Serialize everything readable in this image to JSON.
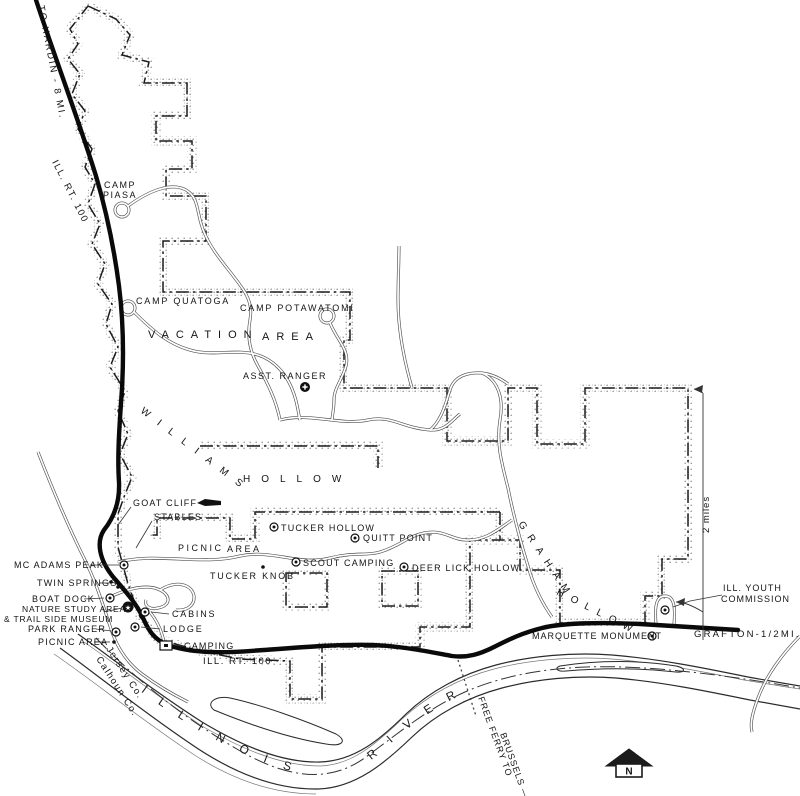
{
  "map": {
    "colors": {
      "ink": "#141414",
      "paper": "#ffffff",
      "stipple": "#8f8f8f",
      "highway": "#0a0a0a"
    }
  },
  "geometry": {
    "boundary": [
      "M88,6 L116,19 L130,35 L122,55 L149,62 L144,83 L187,83 L187,116 L156,116 L156,141 L192,141 L192,169 L166,169 L166,196 L206,196 L206,241 L163,241 L163,292 L350,292 L350,340 L344,340 L344,388 L447,388 L447,441 L508,441 L508,388 L537,388 L537,444 L585,444 L585,388 L688,388 L688,559 L662,559 L662,596 L645,596 L645,623 L560,623 L560,570 L520,570 L520,540 L470,540 L470,627 L420,627 L420,647 L322,647 L322,699 L290,699 L290,661 L240,659 L200,651 L158,639 L140,617 L128,584 L118,547 L118,514 L124,497 L132,477 L120,454 L128,434 L118,411 L125,391 L110,367 L118,347 L106,324 L112,304 L98,284 L105,264 L92,244 L100,224 L88,204 L95,184 L85,167 L92,149 L78,129 L85,111 L72,94 L80,74 L68,59 L78,44 L70,29 Z",
      "M500,512 L255,512 L255,539 L230,539 L230,518 L157,518 L157,535 L150,535",
      "M500,512 L500,540",
      "M200,446 L378,446 L378,468",
      "M286,573 h41 v34 h-41 Z",
      "M382,571 h36 v35 h-36 Z"
    ],
    "roads": [
      "M122,210 m-7,0 a7,7 0 1 0 14,0 a7,7 0 1 0 -14,0",
      "M128,206 C150,190 172,182 186,190 C200,198 196,214 204,232 C212,252 228,268 240,285 C250,298 252,308 250,320 C247,336 250,352 258,366 C268,384 276,400 280,420",
      "M128,308 m-7,0 a7,7 0 1 0 14,0 a7,7 0 1 0 -14,0",
      "M134,312 C152,330 168,344 190,350 C214,357 236,348 258,355 C276,361 288,376 294,394 C298,406 298,412 300,420",
      "M327,316 m-7,0 a7,7 0 1 0 14,0 a7,7 0 1 0 -14,0",
      "M330,323 C338,342 350,350 346,366 C342,380 334,388 334,400 C334,410 332,416 332,420",
      "M280,420 C310,412 340,426 368,420 C392,415 402,428 430,430 C446,431 452,420 460,414",
      "M430,430 C442,420 446,402 450,390 C454,376 468,372 482,373 C492,374 500,378 508,384",
      "M412,388 C404,360 398,330 398,300 C398,280 399,262 399,246",
      "M482,373 C498,380 504,398 500,420 C496,444 502,464 508,488 C512,508 520,540 528,566 C534,588 544,606 552,617",
      "M118,562 C160,552 200,566 240,556 C272,549 300,566 330,558 C352,552 368,556 380,552 C400,546 408,536 424,533 C444,529 452,540 466,540 C486,541 500,528 512,520",
      "M112,596 C130,588 148,584 160,590 C172,596 170,606 158,608 C150,610 144,606 146,600",
      "M160,590 C176,580 192,584 194,596 C195,606 186,611 176,610",
      "M150,612 C158,622 162,632 164,642",
      "M38,452 C52,488 68,526 84,558 C96,582 102,602 110,626 C116,646 126,662 142,674 C158,686 172,694 188,702",
      "M800,636 C782,654 766,676 758,698 C752,714 750,724 752,732",
      "M656,624 C654,602 658,596 665,596 C672,596 676,602 674,624"
    ],
    "highway": "M36,0 C55,58 78,118 96,176 C106,210 114,248 119,286 C123,318 124,352 122,388 C120,420 117,452 119,482 C120,504 112,520 104,530 C96,542 99,560 114,578 C128,594 138,606 144,620 C150,634 158,643 174,647 C204,655 236,652 264,650 C304,647 342,644 372,645 C402,646 430,652 452,656 C468,658 480,654 494,647 C510,639 522,633 542,628 C562,623 600,622 640,624 C674,626 704,628 738,630",
    "river_banks": [
      "M78,634 C112,658 152,690 202,722 C242,746 282,763 320,762 C354,761 380,740 406,714 C430,691 462,674 496,665 C530,656 572,652 612,655 C660,659 704,668 748,677 C770,681 788,684 800,686",
      "M60,648 C96,674 138,708 188,742 C228,770 272,790 318,789 C356,788 386,762 412,737 C436,714 468,697 502,688 C536,679 576,675 616,678 C662,682 706,691 750,700 C772,704 788,707 800,709"
    ],
    "river_banks_detail": [
      "M84,642 C116,664 154,694 202,726 C240,748 280,766 320,766 C352,765 376,744 402,719 C428,695 460,678 494,669 C528,660 572,656 612,659 C658,663 700,671 744,680 C768,684 786,687 800,689",
      "M54,654 C92,680 134,714 184,748 C224,776 268,794 316,794"
    ],
    "islands": [
      "M214,710 C248,724 288,738 326,744 C342,747 348,741 336,734 C304,720 262,705 230,698 C216,695 205,703 214,710 Z",
      "M560,666 C598,660 640,660 676,666 C686,668 686,673 676,672 C640,668 600,668 566,671 C557,672 554,668 560,666 Z"
    ],
    "county_line": "M96,638 C140,684 190,722 242,752 C292,780 332,782 366,757 C400,732 432,705 472,689 C512,673 562,665 622,667 C682,669 742,678 800,688",
    "ferry_line": "M458,660 L476,716",
    "measure_lines": [
      "M703,393 L703,640",
      "M703,393 L694,389",
      "M703,612 C690,604 682,602 676,602"
    ],
    "measure_arrows": [
      "694,389 703,385 702,393",
      "676,602 685,598 684,606"
    ],
    "river_text_path": "M128,682 C178,720 228,752 290,771 C332,783 358,774 388,746 C418,719 444,701 476,689"
  },
  "labels": [
    {
      "id": "to-hardin",
      "text": "TO HARDIN - 8 MI.",
      "x": 38,
      "y": 6,
      "rot": 79,
      "ls": 2,
      "size": 9.5
    },
    {
      "id": "ill-rt-100-top",
      "text": "ILL. RT. 100",
      "x": 52,
      "y": 162,
      "rot": 63,
      "ls": 1.5,
      "size": 9.5
    },
    {
      "id": "camp-piasa-1",
      "text": "CAMP",
      "x": 104,
      "y": 188,
      "ls": 1.5,
      "size": 9
    },
    {
      "id": "camp-piasa-2",
      "text": "PIASA",
      "x": 103,
      "y": 198,
      "ls": 1.5,
      "size": 9
    },
    {
      "id": "camp-quatoga",
      "text": "CAMP QUATOGA",
      "x": 136,
      "y": 304,
      "ls": 1.8,
      "size": 9
    },
    {
      "id": "camp-potawatomi",
      "text": "CAMP POTAWATOMI",
      "x": 240,
      "y": 311,
      "ls": 1.8,
      "size": 9
    },
    {
      "id": "vacation",
      "text": "VACATION",
      "x": 148,
      "y": 338,
      "ls": 7,
      "size": 11
    },
    {
      "id": "vacation-area",
      "text": "AREA",
      "x": 262,
      "y": 340,
      "ls": 7,
      "size": 11
    },
    {
      "id": "asst-ranger",
      "text": "ASST. RANGER",
      "x": 243,
      "y": 379,
      "ls": 1.5,
      "size": 9
    },
    {
      "id": "williams",
      "text": "WILLIAMS",
      "x": 140,
      "y": 412,
      "rot": 37,
      "ls": 11,
      "size": 10
    },
    {
      "id": "williams-hollow",
      "text": "HOLLOW",
      "x": 243,
      "y": 482,
      "ls": 11,
      "size": 10
    },
    {
      "id": "goat-cliff",
      "text": "GOAT CLIFF",
      "x": 133,
      "y": 506,
      "ls": 1.2,
      "size": 9
    },
    {
      "id": "stables",
      "text": "STABLES",
      "x": 154,
      "y": 520,
      "ls": 1.2,
      "size": 9
    },
    {
      "id": "picnic-center",
      "text": "PICNIC",
      "x": 178,
      "y": 551,
      "ls": 2.5,
      "size": 9
    },
    {
      "id": "picnic-center-area",
      "text": "AREA",
      "x": 227,
      "y": 552,
      "ls": 2.5,
      "size": 9
    },
    {
      "id": "tucker-hollow",
      "text": "TUCKER HOLLOW",
      "x": 281,
      "y": 531,
      "ls": 1.2,
      "size": 9
    },
    {
      "id": "quitt-point",
      "text": "QUITT POINT",
      "x": 363,
      "y": 541,
      "ls": 1.2,
      "size": 9
    },
    {
      "id": "scout-camping",
      "text": "SCOUT CAMPING",
      "x": 303,
      "y": 566,
      "ls": 1.2,
      "size": 9
    },
    {
      "id": "tucker-knob",
      "text": "TUCKER KNOB",
      "x": 210,
      "y": 579,
      "ls": 1.8,
      "size": 9
    },
    {
      "id": "deer-lick-hollow",
      "text": "DEER LICK HOLLOW",
      "x": 412,
      "y": 571,
      "ls": 1.2,
      "size": 9
    },
    {
      "id": "graham",
      "text": "GRAHAM",
      "x": 518,
      "y": 524,
      "rot": 56,
      "ls": 8,
      "size": 10
    },
    {
      "id": "graham-hollow",
      "text": "HOLLOW",
      "x": 556,
      "y": 594,
      "rot": 27,
      "ls": 8,
      "size": 10
    },
    {
      "id": "mc-adams-peak",
      "text": "MC ADAMS PEAK",
      "x": 14,
      "y": 568,
      "ls": 1.2,
      "size": 9
    },
    {
      "id": "twin-springs",
      "text": "TWIN SPRINGS",
      "x": 37,
      "y": 586,
      "ls": 1.2,
      "size": 9
    },
    {
      "id": "boat-dock",
      "text": "BOAT DOCK",
      "x": 32,
      "y": 602,
      "ls": 1.2,
      "size": 9
    },
    {
      "id": "nature-study-area",
      "text": "NATURE STUDY AREA",
      "x": 22,
      "y": 612,
      "ls": 0.8,
      "size": 8.5
    },
    {
      "id": "trail-side-museum",
      "text": "& TRAIL SIDE MUSEUM",
      "x": 4,
      "y": 622,
      "ls": 0.8,
      "size": 8.5
    },
    {
      "id": "park-ranger",
      "text": "PARK RANGER",
      "x": 28,
      "y": 632,
      "ls": 1.2,
      "size": 9
    },
    {
      "id": "picnic-west",
      "text": "PICNIC AREA",
      "x": 38,
      "y": 645,
      "ls": 1.2,
      "size": 9
    },
    {
      "id": "cabins",
      "text": "CABINS",
      "x": 172,
      "y": 617,
      "ls": 1.8,
      "size": 9
    },
    {
      "id": "lodge",
      "text": "LODGE",
      "x": 163,
      "y": 632,
      "ls": 1.8,
      "size": 9
    },
    {
      "id": "camping",
      "text": "CAMPING",
      "x": 184,
      "y": 649,
      "ls": 1.2,
      "size": 9
    },
    {
      "id": "ill-rt-100-bottom",
      "text": "ILL. RT. 100",
      "x": 203,
      "y": 664,
      "ls": 1.5,
      "size": 9.5
    },
    {
      "id": "marquette-monument",
      "text": "MARQUETTE MONUMENT",
      "x": 532,
      "y": 639,
      "ls": 1,
      "size": 9
    },
    {
      "id": "grafton",
      "text": "GRAFTON-1/2MI.",
      "x": 694,
      "y": 637,
      "ls": 2.2,
      "size": 9.5
    },
    {
      "id": "ill-youth",
      "text": "ILL. YOUTH",
      "x": 723,
      "y": 591,
      "ls": 1,
      "size": 9
    },
    {
      "id": "commission",
      "text": "COMMISSION",
      "x": 721,
      "y": 602,
      "ls": 1,
      "size": 9
    },
    {
      "id": "two-miles",
      "text": "2 miles",
      "x": 709,
      "y": 533,
      "rot": -90,
      "ls": 1,
      "size": 9.5
    },
    {
      "id": "jersey-co",
      "text": "Jersey Co.",
      "x": 106,
      "y": 649,
      "rot": 57,
      "ls": 1.5,
      "size": 9.5
    },
    {
      "id": "calhoun-co",
      "text": "Calhoun Co.",
      "x": 96,
      "y": 659,
      "rot": 57,
      "ls": 1.5,
      "size": 9.5
    },
    {
      "id": "free-ferry-to",
      "text": "FREE FERRY TO",
      "x": 478,
      "y": 698,
      "rot": 70,
      "ls": 1,
      "size": 9
    },
    {
      "id": "brussels",
      "text": "BRUSSELS —",
      "x": 500,
      "y": 734,
      "rot": 70,
      "ls": 1,
      "size": 9
    }
  ],
  "river_text": {
    "word1": "I L L I N O I S",
    "word2": "R I V E R",
    "size": 12,
    "ls": 7
  },
  "symbols": [
    {
      "type": "ring-dot",
      "x": 274,
      "y": 527
    },
    {
      "type": "ring-dot",
      "x": 355,
      "y": 538
    },
    {
      "type": "ring-dot",
      "x": 296,
      "y": 562
    },
    {
      "type": "ring-dot",
      "x": 404,
      "y": 567
    },
    {
      "type": "ring-dot",
      "x": 652,
      "y": 636
    },
    {
      "type": "ring-dot",
      "x": 665,
      "y": 610
    },
    {
      "type": "ring-dot",
      "x": 110,
      "y": 598
    },
    {
      "type": "ring-dot",
      "x": 145,
      "y": 612
    },
    {
      "type": "ring-dot",
      "x": 135,
      "y": 627
    },
    {
      "type": "ring-dot",
      "x": 116,
      "y": 632
    },
    {
      "type": "ring-dot",
      "x": 124,
      "y": 565
    },
    {
      "type": "dot",
      "x": 114,
      "y": 642
    },
    {
      "type": "dot",
      "x": 111,
      "y": 582
    },
    {
      "type": "dot",
      "x": 118,
      "y": 587
    },
    {
      "type": "dot",
      "x": 263,
      "y": 567
    },
    {
      "type": "star-circle",
      "x": 128,
      "y": 607
    },
    {
      "type": "cross-circle",
      "x": 305,
      "y": 387
    },
    {
      "type": "square",
      "x": 160,
      "y": 641
    },
    {
      "type": "cliff-bar",
      "x": 197,
      "y": 499
    }
  ],
  "leaders": [
    [
      90,
      565,
      119,
      565
    ],
    [
      99,
      583,
      109,
      583
    ],
    [
      84,
      599,
      104,
      598
    ],
    [
      104,
      612,
      122,
      608
    ],
    [
      96,
      629,
      111,
      631
    ],
    [
      94,
      642,
      110,
      642
    ],
    [
      169,
      614,
      151,
      612
    ],
    [
      160,
      629,
      141,
      627
    ],
    [
      181,
      646,
      168,
      644
    ],
    [
      131,
      507,
      118,
      525
    ],
    [
      152,
      521,
      136,
      548
    ],
    [
      722,
      595,
      690,
      601
    ],
    [
      690,
      601,
      673,
      607
    ]
  ],
  "north_arrow": {
    "label": "N",
    "roof": "606,766 629,749 652,766",
    "body": {
      "x": 616,
      "y": 764,
      "w": 26,
      "h": 13
    }
  }
}
